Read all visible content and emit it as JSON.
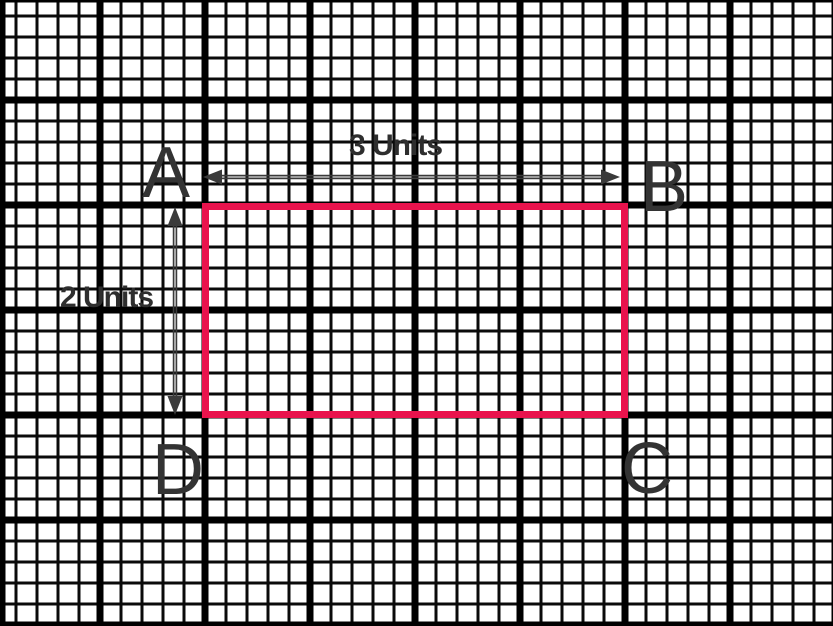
{
  "colors": {
    "paper": "#ffffff",
    "grid_thin": "#0b0b0b",
    "grid_bold": "#000000",
    "rect_stroke": "#e9134d",
    "letter_ink": "#333333",
    "dim_ink": "#2e2e2e",
    "arrow_ink": "#3a3a3a"
  },
  "figure": {
    "shape": "rectangle",
    "background": "graph-paper",
    "corners": [
      {
        "label": "A",
        "position": "top-left"
      },
      {
        "label": "B",
        "position": "top-right"
      },
      {
        "label": "C",
        "position": "bottom-right"
      },
      {
        "label": "D",
        "position": "bottom-left"
      }
    ],
    "width_label": "3 Units",
    "height_label": "2 Units",
    "width_units": 3,
    "height_units": 2
  }
}
